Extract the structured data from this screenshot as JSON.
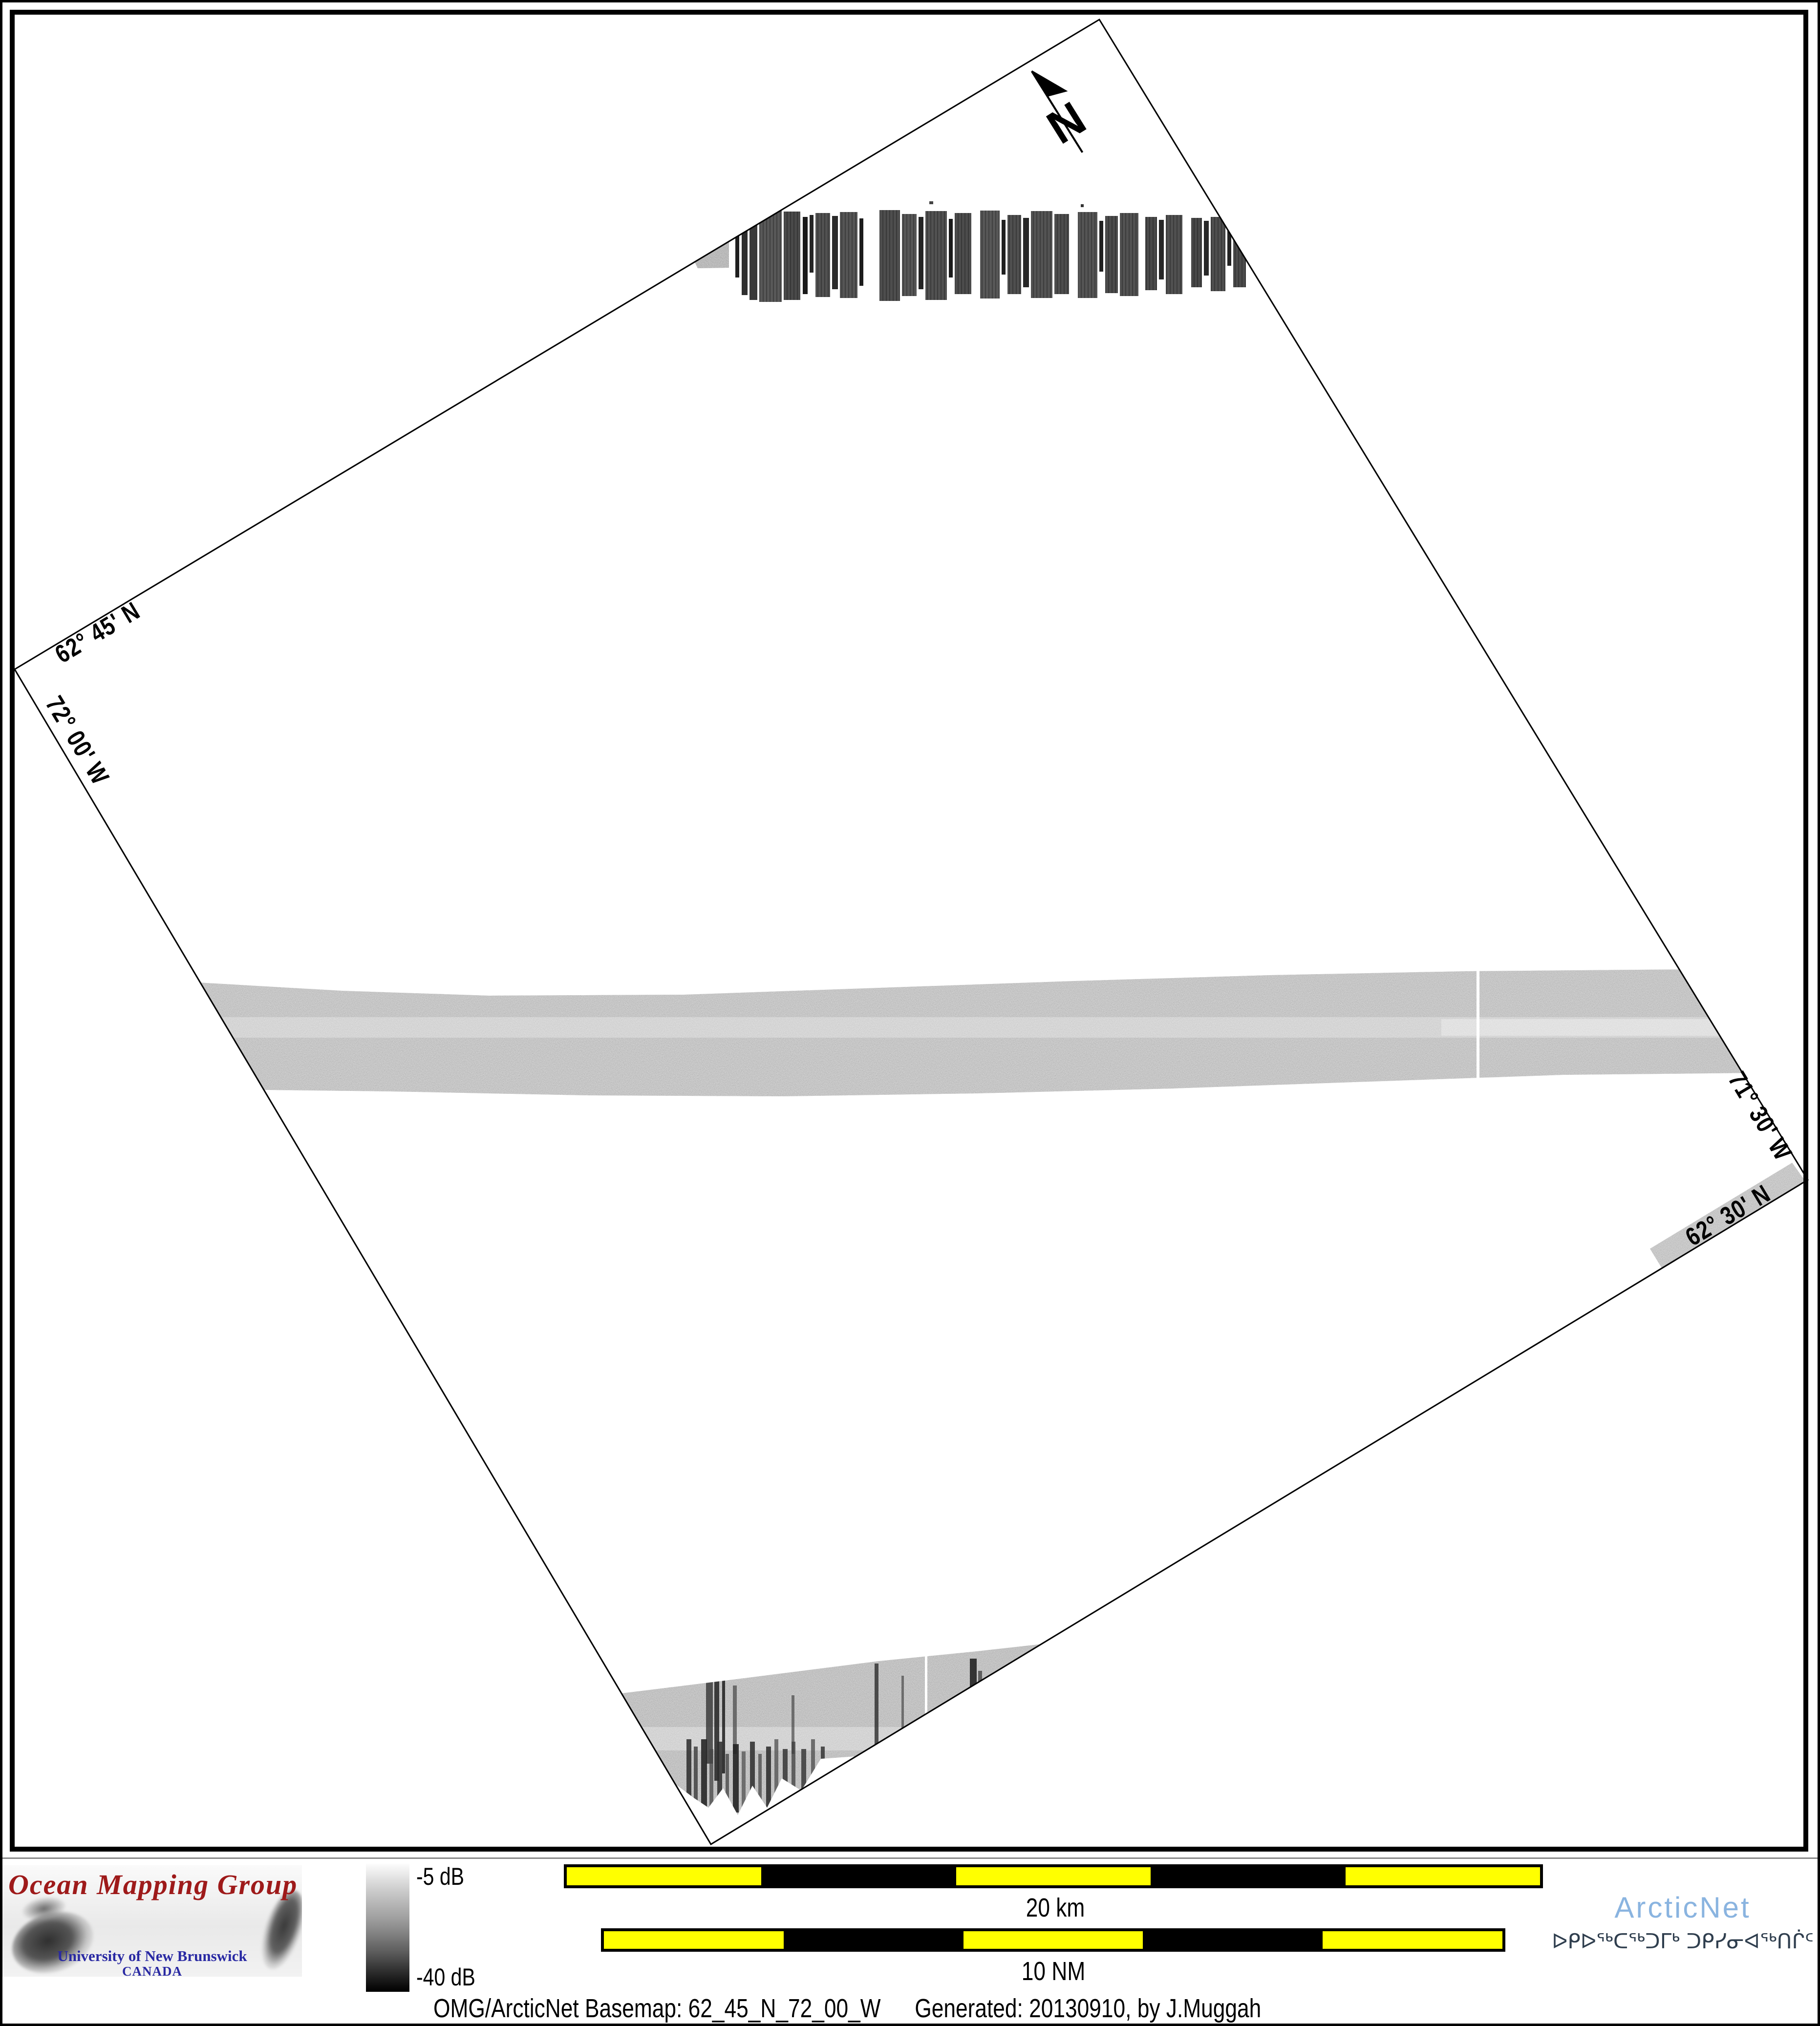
{
  "map": {
    "graticule_labels": {
      "lat_top": "62° 45' N",
      "lon_left": "72° 00' W",
      "lon_right": "71° 30' W",
      "lat_bottom": "62° 30' N"
    },
    "north_label": "N"
  },
  "legend": {
    "colorbar": {
      "max_label": "-5 dB",
      "min_label": "-40 dB",
      "top_color": "#fcfcfc",
      "bottom_color": "#000000"
    },
    "scalebar_km": {
      "label": "20 km",
      "segments": 5
    },
    "scalebar_nm": {
      "label": "10 NM",
      "segments": 5
    },
    "colors": {
      "segment_yellow": "#ffff00",
      "segment_black": "#000000"
    }
  },
  "logos": {
    "omg": {
      "title": "Ocean Mapping Group",
      "institution": "University of New Brunswick",
      "country": "CANADA",
      "title_color": "#9e1a1a",
      "text_color": "#2929a3"
    },
    "arcticnet": {
      "name": "ArcticNet",
      "inuktitut": "ᐅᑭᐅᖅᑕᖅᑐᒥᒃ ᑐᑭᓯᓂᐊᖅᑎᒌᑦ",
      "name_color": "#8ab4e0",
      "inuktitut_color": "#2f3e4e"
    }
  },
  "footer": {
    "basemap": "OMG/ArcticNet Basemap: 62_45_N_72_00_W",
    "generated": "Generated: 20130910, by J.Muggah"
  }
}
